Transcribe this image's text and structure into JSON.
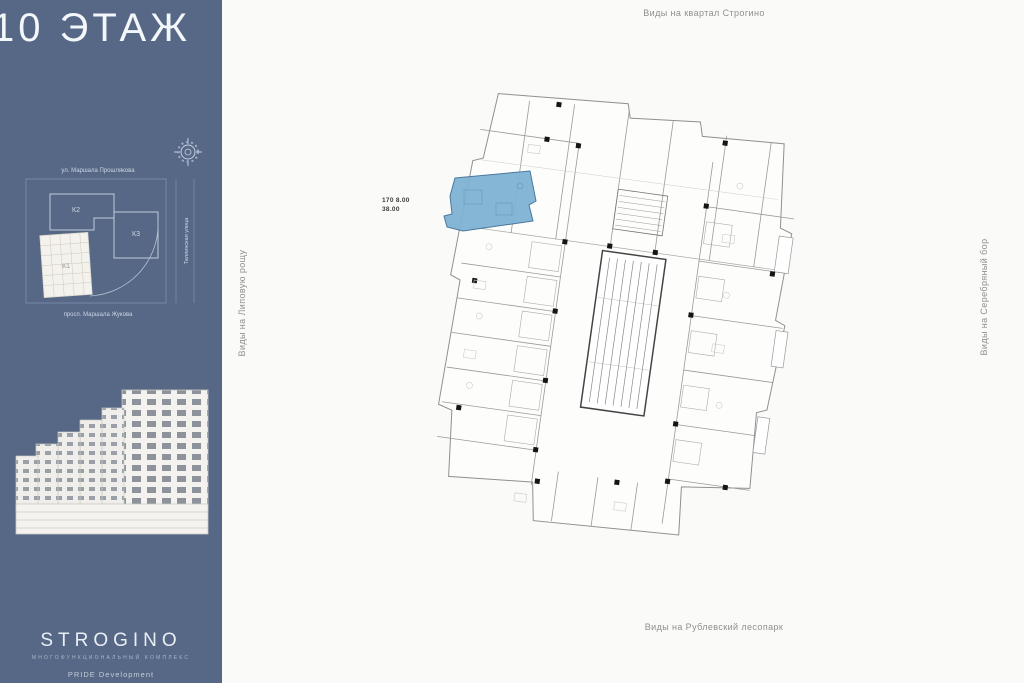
{
  "sidebar": {
    "floor_title": "10 ЭТАЖ",
    "bg_color": "#566886",
    "site_plan": {
      "street_top": "ул. Маршала Прошлякова",
      "street_bottom": "просп. Маршала Жукова",
      "street_right": "Таллинская улица",
      "building_k2": "К2",
      "building_k3": "К3",
      "building_k1": "К1"
    },
    "logo": {
      "title": "STROGINO",
      "subtitle": "МНОГОФУНКЦИОНАЛЬНЫЙ КОМПЛЕКС",
      "developer": "PRIDE Development"
    }
  },
  "plan": {
    "view_labels": {
      "top": "Виды на квартал Строгино",
      "left": "Виды на Липовую рощу",
      "right": "Виды на Серебряный бор",
      "bottom": "Виды на Рублевский лесопарк"
    },
    "highlighted_unit": {
      "callout_line1": "170 8.00",
      "callout_line2": "38.00",
      "fill_color": "#7fb2d4"
    }
  }
}
